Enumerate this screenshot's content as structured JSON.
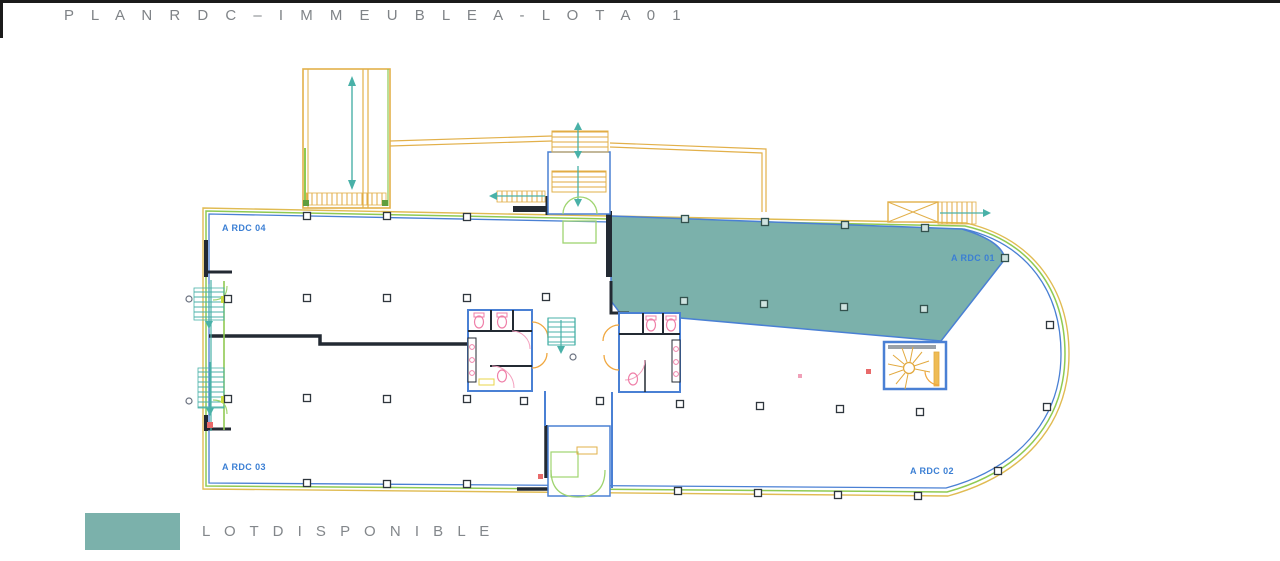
{
  "page": {
    "title": "P L A N   R D C   –   I M M E U B L E   A   -   L O T   A 0 1"
  },
  "legend": {
    "label": "L O T   D I S P O N I B L E",
    "swatch_color": "#7bb1ab"
  },
  "plan": {
    "floor": "RDC",
    "building": "IMMEUBLE A",
    "lots": [
      {
        "id": "a-rdc-01",
        "label": "A RDC 01",
        "available": true
      },
      {
        "id": "a-rdc-02",
        "label": "A RDC 02",
        "available": false
      },
      {
        "id": "a-rdc-03",
        "label": "A RDC 03",
        "available": false
      },
      {
        "id": "a-rdc-04",
        "label": "A RDC 04",
        "available": false
      }
    ],
    "colors": {
      "available_fill": "#7bb1ab",
      "wall_blue": "#4a80d4",
      "wall_dark": "#232a33",
      "outline_yellow": "#e0bb52",
      "outline_green": "#8fca52",
      "stair_orange": "#e2a93f",
      "stair_teal": "#49b1a8",
      "fixture_pink": "#ef7fa8",
      "door_green": "#9fd470",
      "label_blue": "#3b7fd4"
    }
  }
}
